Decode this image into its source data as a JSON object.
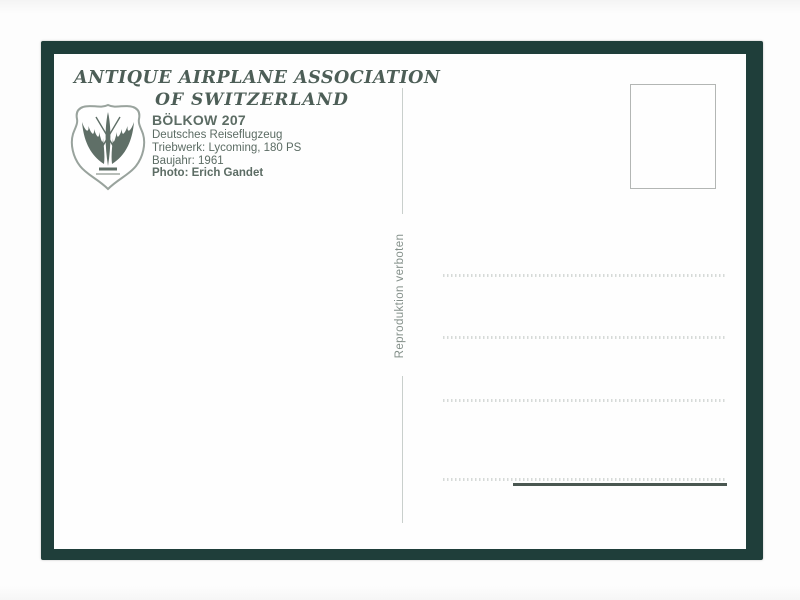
{
  "postcard": {
    "header": {
      "line1": "ANTIQUE AIRPLANE ASSOCIATION",
      "line2": "OF SWITZERLAND"
    },
    "details": {
      "title": "BÖLKOW 207",
      "line1": "Deutsches Reiseflugzeug",
      "line2": "Triebwerk: Lycoming, 180 PS",
      "line3": "Baujahr: 1961",
      "photo_credit": "Photo: Erich Gandet"
    },
    "side_note": "Reproduktion verboten",
    "logo": "association-crest-wings-propeller"
  },
  "colors": {
    "frame": "#1f3e3a",
    "card": "#fefefe",
    "ink": "#5c6c64",
    "header_ink": "#4d5e57",
    "side_note_ink": "#84908a",
    "dotted_line": "#d6dad8",
    "solid_line": "#4a5751",
    "stamp_border": "#b3b6b4",
    "divider": "#c9cfcc"
  }
}
